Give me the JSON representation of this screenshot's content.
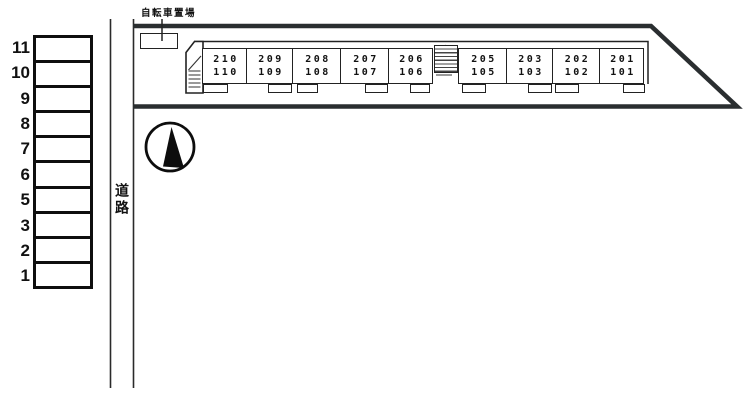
{
  "site": {
    "bicycle_label": "自転車置場",
    "road_label": "道路"
  },
  "parking": {
    "spaces": [
      "11",
      "10",
      "9",
      "8",
      "7",
      "6",
      "5",
      "3",
      "2",
      "1"
    ]
  },
  "building": {
    "units": [
      {
        "upper": "210",
        "lower": "110"
      },
      {
        "upper": "209",
        "lower": "109"
      },
      {
        "upper": "208",
        "lower": "108"
      },
      {
        "upper": "207",
        "lower": "107"
      },
      {
        "upper": "206",
        "lower": "106"
      },
      {
        "upper": "205",
        "lower": "105"
      },
      {
        "upper": "203",
        "lower": "103"
      },
      {
        "upper": "202",
        "lower": "102"
      },
      {
        "upper": "201",
        "lower": "101"
      }
    ]
  },
  "icons": {
    "north_arrow": "compass-north-arrow",
    "stairs_front": "stairs-hatch",
    "stairs_middle": "stairs-hatch"
  },
  "colors": {
    "boundary": "#2a2e30",
    "line": "#222222",
    "background": "#ffffff"
  }
}
